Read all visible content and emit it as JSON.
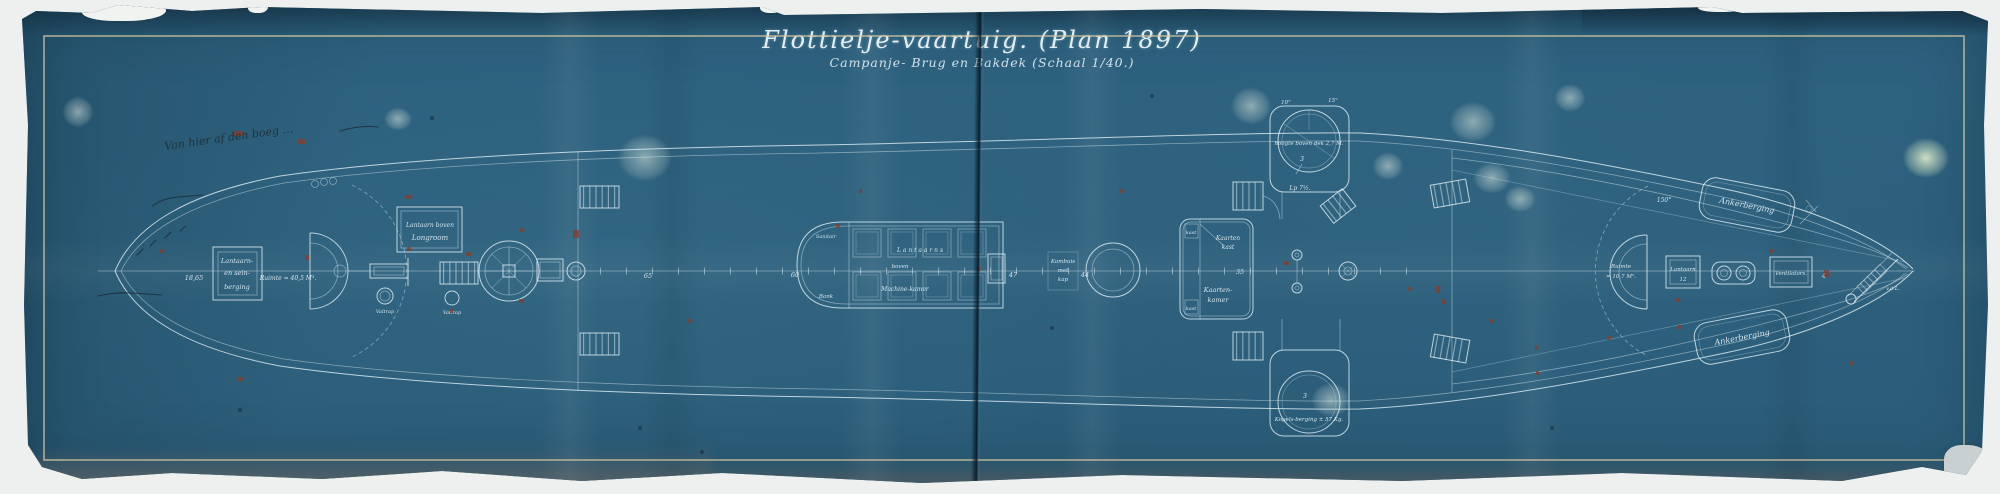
{
  "title": {
    "main": "Flottielje-vaartuig. (Plan 1897)",
    "sub": "Campanje- Brug en Bakdek (Schaal 1/40.)"
  },
  "pencil_notes": {
    "bow_note": "Van hier af den boeg …"
  },
  "labels": {
    "bow_store": [
      "Lantaarn-",
      "en sein-",
      "berging"
    ],
    "bow_space": "Ruimte = 40,5 M³.",
    "valtrap_1": "Valtrap",
    "valtrap_2": "Valtrap",
    "longroom": [
      "Lantaarn boven",
      "Longroom"
    ],
    "engine": [
      "L a n t a a r n s",
      "boven",
      "Machine-kamer"
    ],
    "sanitair": "Sanitair",
    "bank": "Bank",
    "kombuis": [
      "Kombuis",
      "met",
      "kap"
    ],
    "kast_top": "kast",
    "kast_bottom": "kast",
    "chart_cupboard": [
      "Kaarten",
      "kast"
    ],
    "chart_room": [
      "Kaarten-",
      "kamer"
    ],
    "platform_note": "hoogte boven dek 2,7 M.",
    "platform_num_top": "3",
    "platform_num_bottom": "3",
    "shell_store": "Kogels-berging ± 57 Kg.",
    "anchor_store_top": "Ankerberging",
    "anchor_store_bottom": "Ankerberging",
    "stern_space": [
      "Ruimte",
      "= 10,7 M²."
    ],
    "stern_lantern": "Lantaarn",
    "ventilators": "Ventilators.",
    "stern_tip": "v.d.L."
  },
  "dimensions": {
    "bow_len": "18,65",
    "d65": "65",
    "d60": "60",
    "d47": "47",
    "d44": "44",
    "d35": "35",
    "d12": "12",
    "d4": "4",
    "lp": "Lp 7½.",
    "deg150": "150°",
    "deg10": "10°",
    "deg15": "15°"
  },
  "colors": {
    "sheet_blue": "#2e6380",
    "drawing_line": "#d8e9f0",
    "border_line": "#cfc5a2",
    "red_annotation": "#8a3a27",
    "pencil": "#1b2b33"
  }
}
